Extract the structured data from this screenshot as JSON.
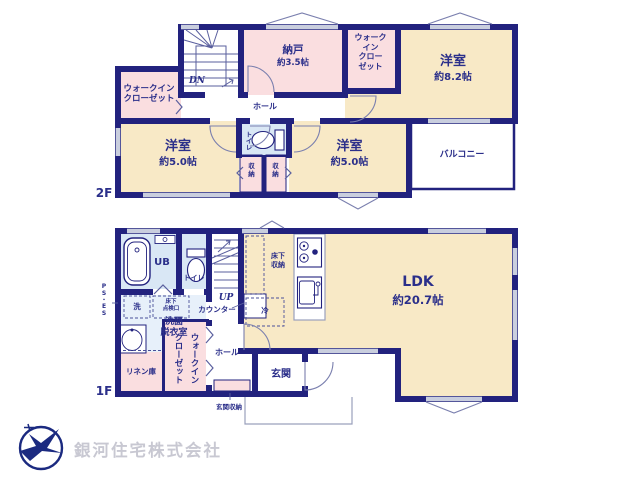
{
  "floors": {
    "f2": {
      "label": "2F",
      "rooms": {
        "wic_left": "ウォークイン\nクローゼット",
        "stairs": "DN",
        "storage_room": {
          "name": "納戸",
          "size": "約3.5帖"
        },
        "wic_top": "ウォーク\nイン\nクロー\nゼット",
        "bedroom_a": {
          "name": "洋室",
          "size": "約8.2帖"
        },
        "hall": "ホール",
        "bedroom_b": {
          "name": "洋室",
          "size": "約5.0帖"
        },
        "toilet": "トイレ",
        "closet_a": "収\n納",
        "closet_b": "収\n納",
        "bedroom_c": {
          "name": "洋室",
          "size": "約5.0帖"
        },
        "balcony": "バルコニー"
      }
    },
    "f1": {
      "label": "1F",
      "rooms": {
        "ub": "UB",
        "toilet": "トイレ",
        "stairs": "UP",
        "counter": "カウンター",
        "underfloor_storage": "床下\n収納",
        "fridge": "冷",
        "washer": "洗",
        "inspection_hatch": "床下\n点検口",
        "washroom": "洗面\n脱衣室",
        "ps_es": "P\nS\n・\nE\nS",
        "linen_closet": "リネン庫",
        "wic": "ウォークイン\nクローゼット",
        "hall": "ホール",
        "entrance_storage": "玄関収納",
        "entrance": "玄関",
        "ldk": {
          "name": "LDK",
          "size": "約20.7帖"
        }
      }
    }
  },
  "footer": {
    "company": "銀河住宅株式会社"
  },
  "colors": {
    "wall": "#22227e",
    "room_cream": "#f8e9c6",
    "room_pink": "#fadee0",
    "room_blue": "#d9e7f5",
    "washroom_blue": "#e7f0fa",
    "window_gray": "#c9cede",
    "label_text": "#2b2f8a",
    "thin_line": "#7a7fae",
    "logo_navy": "#1b2a80",
    "company_text": "#c8c8d2"
  }
}
